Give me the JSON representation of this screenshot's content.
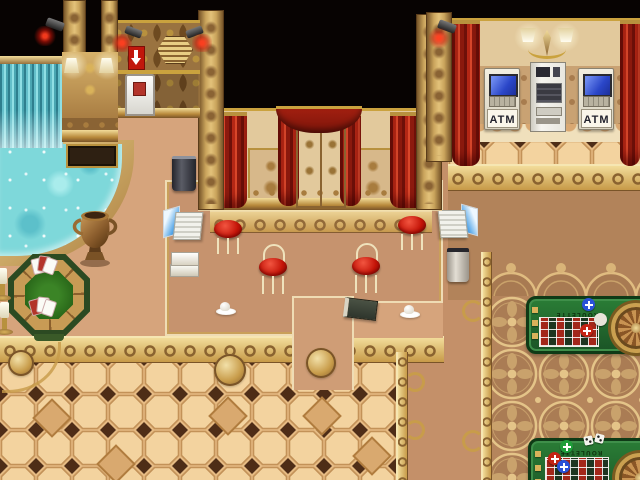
{
  "meta": {
    "description": "RPG-style casino interior scene with pool, poker table, service counter, ATMs and roulette tables"
  },
  "labels": {
    "atm_left": "ATM",
    "atm_right": "ATM",
    "roulette_top": "ROULETTE",
    "roulette_bottom": "ROULETTE"
  },
  "palette": {
    "void_black": "#070302",
    "gold_light": "#f2dc9a",
    "gold": "#c89c4a",
    "gold_dark": "#7a5428",
    "wall_cream": "#e2c99c",
    "curtain_red": "#b42715",
    "floor_tan": "#d6a47c",
    "platform_tan": "#c6936e",
    "tile_cream": "#f3d39f",
    "tile_diamond": "#4e2d17",
    "water_cyan": "#7ed8da",
    "felt_green": "#1f6b2e",
    "screen_blue": "#2a46c8",
    "chair_red": "#c41408"
  },
  "objects": [
    {
      "name": "waterfall",
      "count": 1
    },
    {
      "name": "pool",
      "count": 1
    },
    {
      "name": "bronze-urn",
      "count": 1
    },
    {
      "name": "poker-table",
      "count": 1
    },
    {
      "name": "playing-cards",
      "count": 2
    },
    {
      "name": "candle-stand",
      "count": 2
    },
    {
      "name": "security-camera",
      "count": 4
    },
    {
      "name": "wall-lamp",
      "count": 2
    },
    {
      "name": "hex-vent",
      "count": 1
    },
    {
      "name": "exit-sign",
      "count": 1
    },
    {
      "name": "utility-door",
      "count": 1
    },
    {
      "name": "golden-double-door",
      "count": 1
    },
    {
      "name": "red-curtain",
      "count": 6
    },
    {
      "name": "bar-chair",
      "count": 4
    },
    {
      "name": "laptop",
      "count": 2
    },
    {
      "name": "book-stack",
      "count": 1
    },
    {
      "name": "ledger-book",
      "count": 1
    },
    {
      "name": "coffee-cup",
      "count": 2
    },
    {
      "name": "trash-bin",
      "count": 2
    },
    {
      "name": "atm-machine",
      "count": 2
    },
    {
      "name": "vending-machine",
      "count": 1
    },
    {
      "name": "chandelier-sconce",
      "count": 1
    },
    {
      "name": "roulette-table",
      "count": 2
    },
    {
      "name": "roulette-wheel",
      "count": 2
    },
    {
      "name": "casino-chip",
      "count": 6
    },
    {
      "name": "dice-pair",
      "count": 1
    }
  ]
}
